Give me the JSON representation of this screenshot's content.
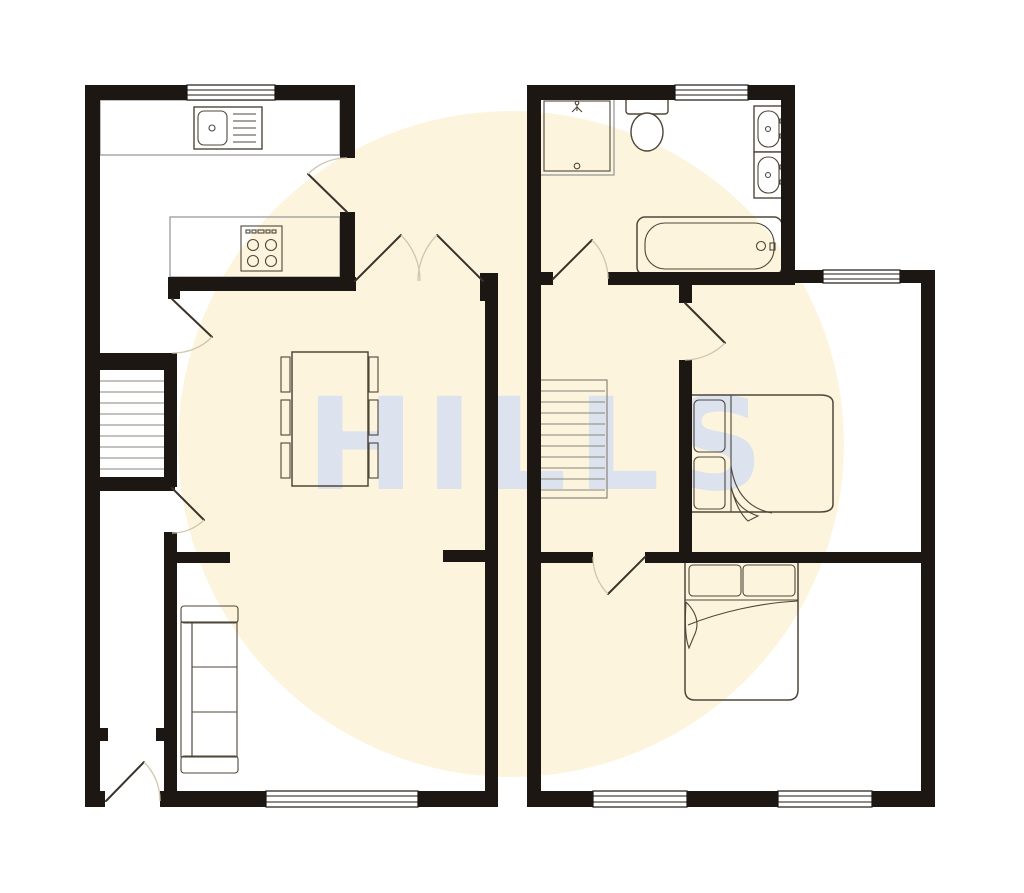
{
  "watermark": {
    "text": "HILLS",
    "circle_color": "#fcf4dd",
    "text_color": "#dce3ef"
  },
  "colors": {
    "background": "#ffffff",
    "wall": "#1c1713",
    "window_line": "#1c1713",
    "counter_stroke": "#9a9a9a",
    "furniture_stroke": "#4f4639",
    "door_leaf": "#3a332a",
    "door_arc": "#cfc6ad",
    "stair_tread": "#8a857a"
  },
  "floors": {
    "ground_floor": {
      "fixtures": [
        "kitchen-sink",
        "hob",
        "double-patio-doors",
        "dining-table",
        "dining-chairs",
        "staircase",
        "sofa",
        "entrance-door"
      ]
    },
    "first_floor": {
      "fixtures": [
        "shower",
        "toilet",
        "wash-basin",
        "wash-basin",
        "bathtub",
        "staircase",
        "double-bed",
        "double-bed"
      ]
    }
  }
}
